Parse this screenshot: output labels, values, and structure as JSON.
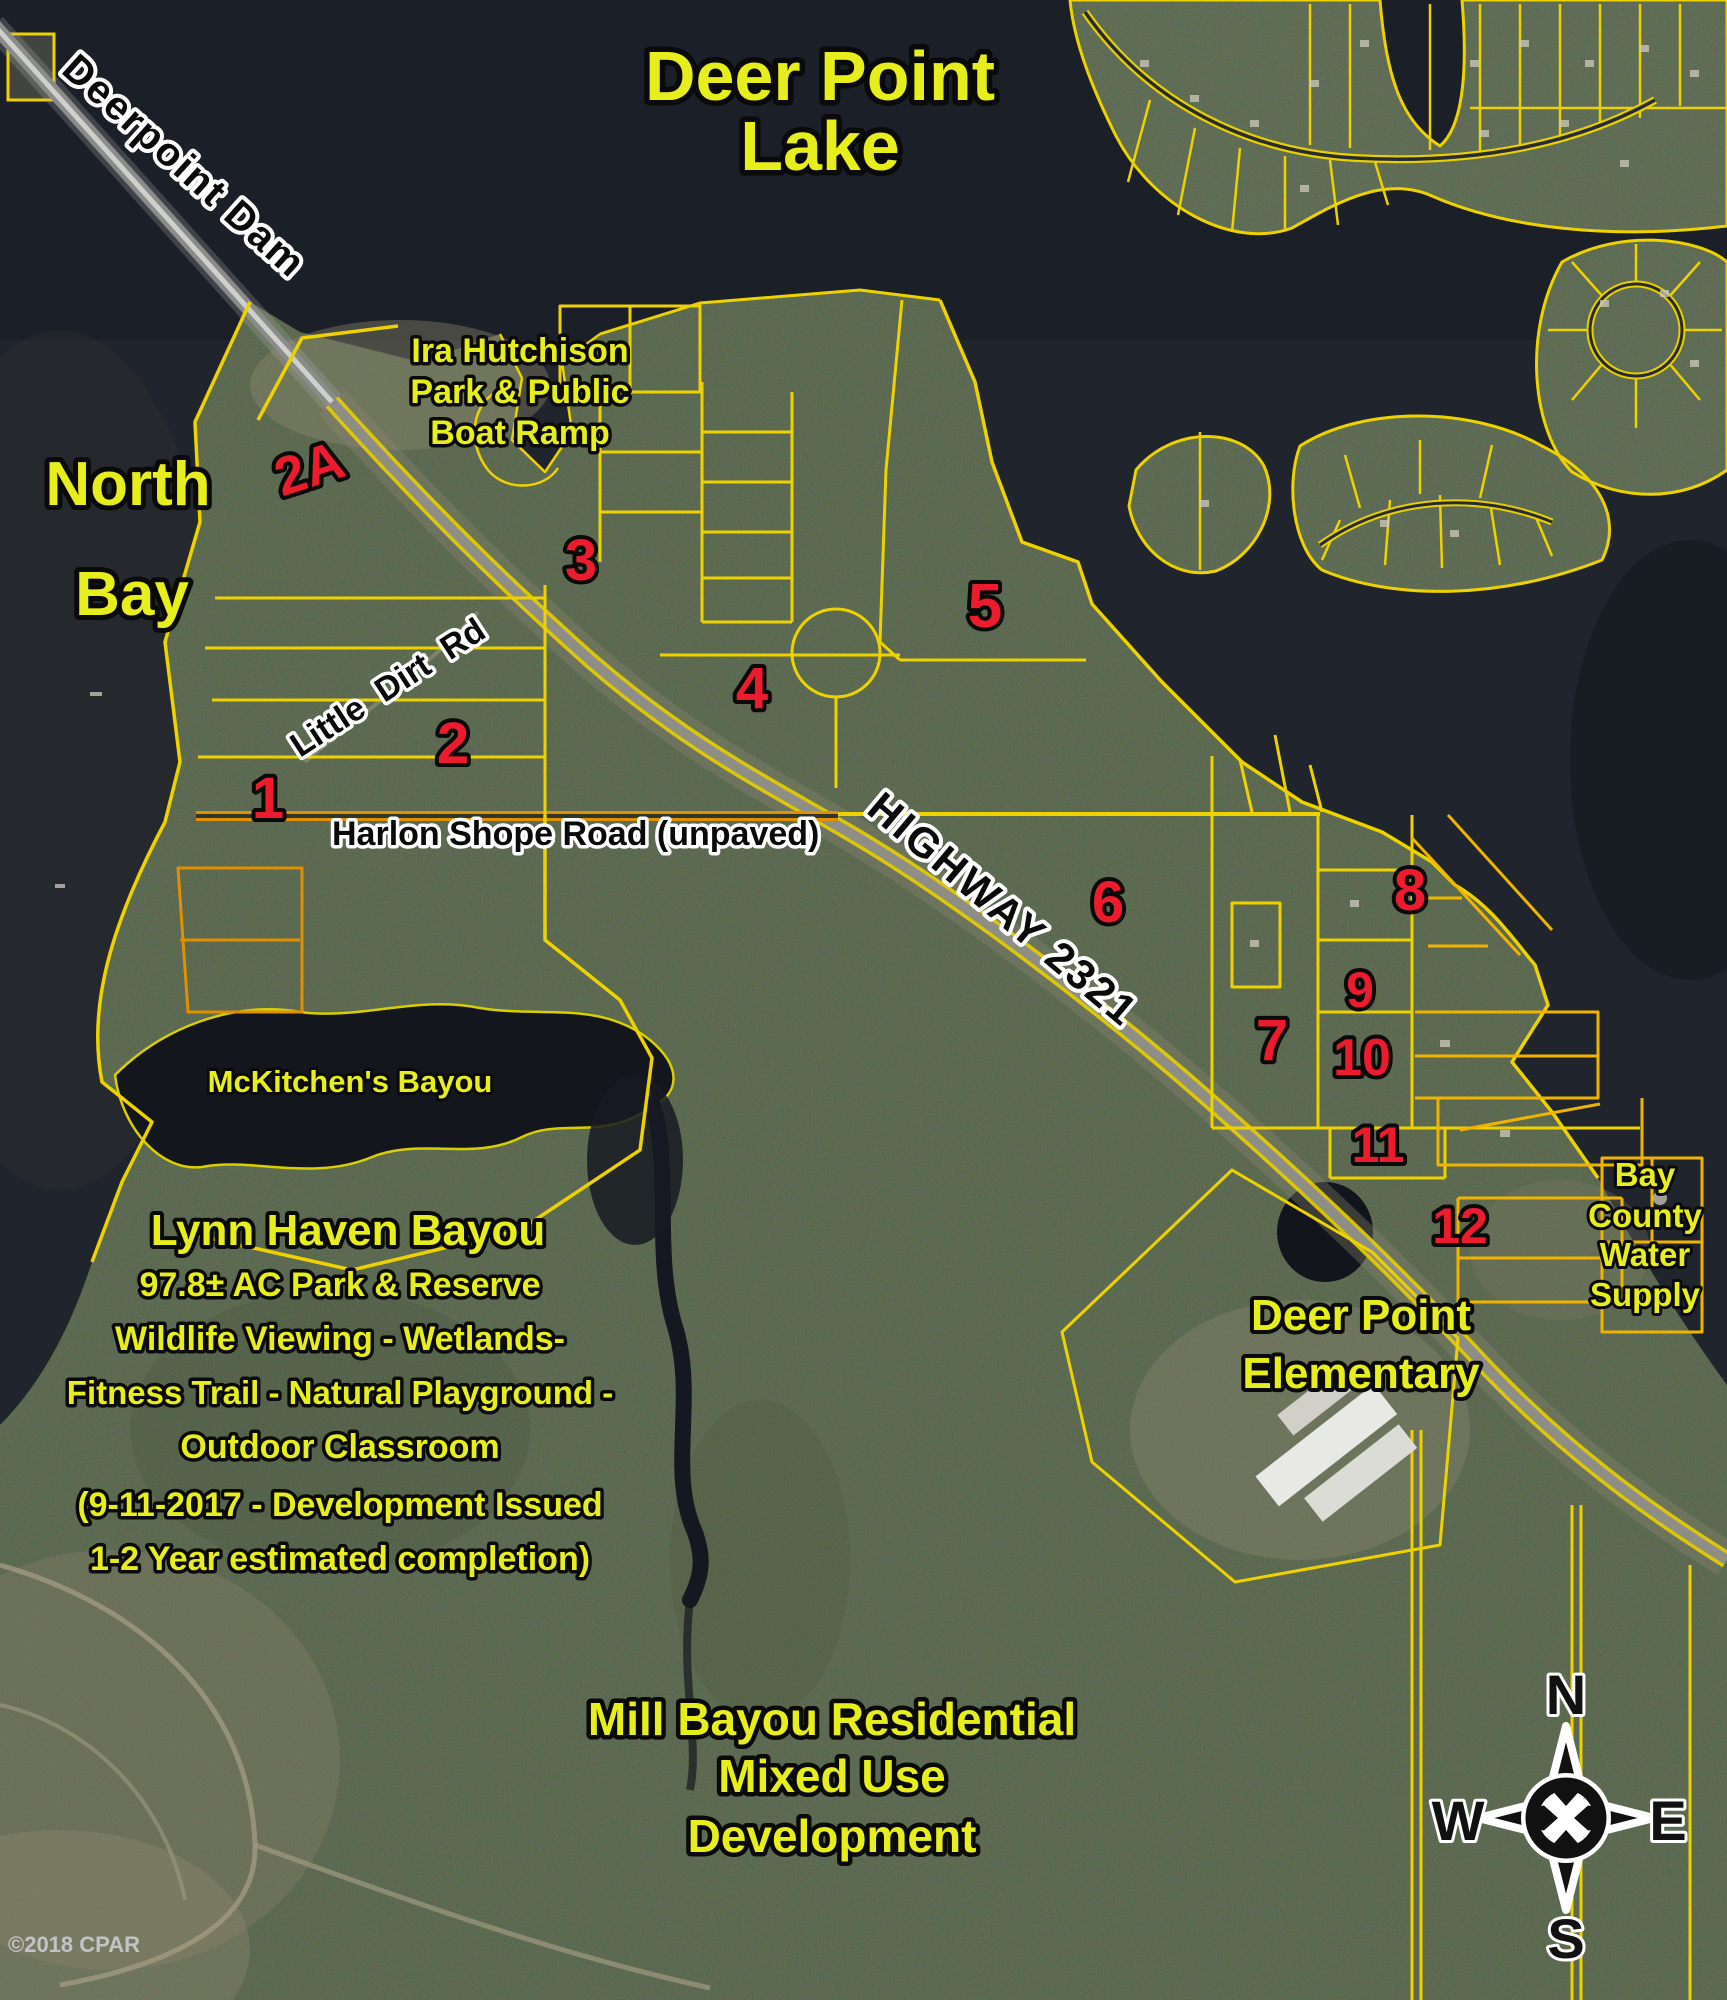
{
  "map_title": "Deer Point Lake aerial parcel map",
  "colors": {
    "water": "#20242d",
    "lake_water": "#191d26",
    "land": "#3a4131",
    "parcel_line": "#eed200",
    "road_orange": "#e09000",
    "label_yellow": "#e6ee1c",
    "label_red": "#ec1c2e",
    "outline_black": "#0a0a0a",
    "outline_white": "#ffffff"
  },
  "water_labels": {
    "lake_line1": "Deer Point",
    "lake_line2": "Lake",
    "bay_line1": "North",
    "bay_line2": "Bay",
    "mckitchens": "McKitchen's Bayou"
  },
  "roads": {
    "dam": "Deerpoint Dam",
    "little_dirt": "Little  Dirt  Rd",
    "harlon": "Harlon Shope Road (unpaved)",
    "highway": "HIGHWAY 2321"
  },
  "park": [
    "Ira Hutchison",
    "Park & Public",
    "Boat Ramp"
  ],
  "reserve": [
    "Lynn Haven Bayou",
    "97.8± AC  Park & Reserve",
    "Wildlife Viewing - Wetlands-",
    "Fitness Trail - Natural Playground -",
    "Outdoor Classroom",
    "(9-11-2017 - Development Issued",
    "1-2 Year estimated completion)"
  ],
  "school": [
    "Deer Point",
    "Elementary"
  ],
  "water_supply": [
    "Bay",
    "County",
    "Water",
    "Supply"
  ],
  "mill": [
    "Mill Bayou Residential",
    "Mixed Use",
    "Development"
  ],
  "parcel_labels": {
    "p1": "1",
    "p2": "2",
    "p2a": "2A",
    "p3": "3",
    "p4": "4",
    "p5": "5",
    "p6": "6",
    "p7": "7",
    "p8": "8",
    "p9": "9",
    "p10": "10",
    "p11": "11",
    "p12": "12"
  },
  "compass": {
    "n": "N",
    "w": "W",
    "e": "E",
    "s": "S"
  },
  "watermark": "©2018 CPAR"
}
